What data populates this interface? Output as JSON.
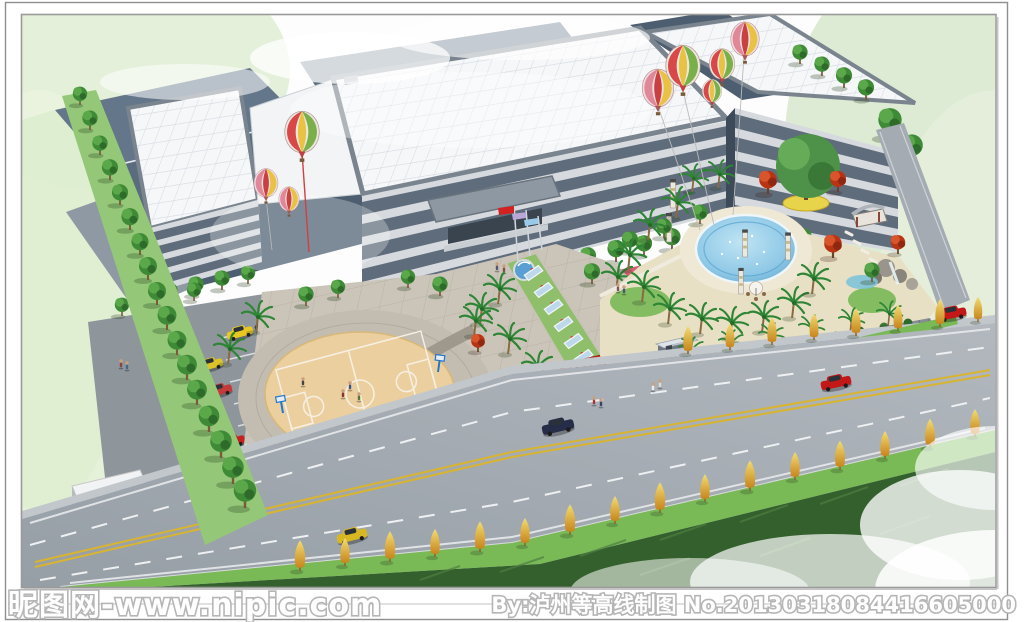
{
  "image": {
    "type": "architectural-rendering",
    "subject": "bird's-eye landscape design rendering of a factory campus with office building, entrance plaza, basketball court, swimming-pool garden and roadside greenery"
  },
  "watermarks": {
    "left": "昵图网-www.nipic.com",
    "right": "By:泸州等高线制图 No.20130318084416605000"
  },
  "palette": {
    "slate_roof": "#5a6c7e",
    "slate_roof2": "#4c5e70",
    "slate_roof3": "#647689",
    "white_roof": "#f5f7f9",
    "facade_wall": "#d6dade",
    "facade_window": "#5f6c7c",
    "plaza": "#cbc5b9",
    "court": "#eccf9e",
    "pool": "#8fc8e6",
    "road": "#a4abb2",
    "parking": "#8e959b",
    "lawn": "#79b956",
    "field": "#33602c",
    "tree_green": "#3f8a37",
    "tree_red": "#c23a1a",
    "tree_yellow": "#e2b33c",
    "balloon_red": "#d84848",
    "flag_red": "#d42222",
    "corner_wash": "#e0eed6"
  },
  "objects": [
    "factory sheds",
    "main office building",
    "right wing building",
    "entrance canopy",
    "hot-air balloons",
    "flag poles",
    "entrance walkway with glass panels",
    "red welcome sign",
    "swimming pool",
    "gazebo",
    "rockery waterfall",
    "basketball court",
    "parking lot",
    "gatehouse",
    "barrier gate",
    "main road with cars",
    "roadside golden trees",
    "grass field"
  ]
}
